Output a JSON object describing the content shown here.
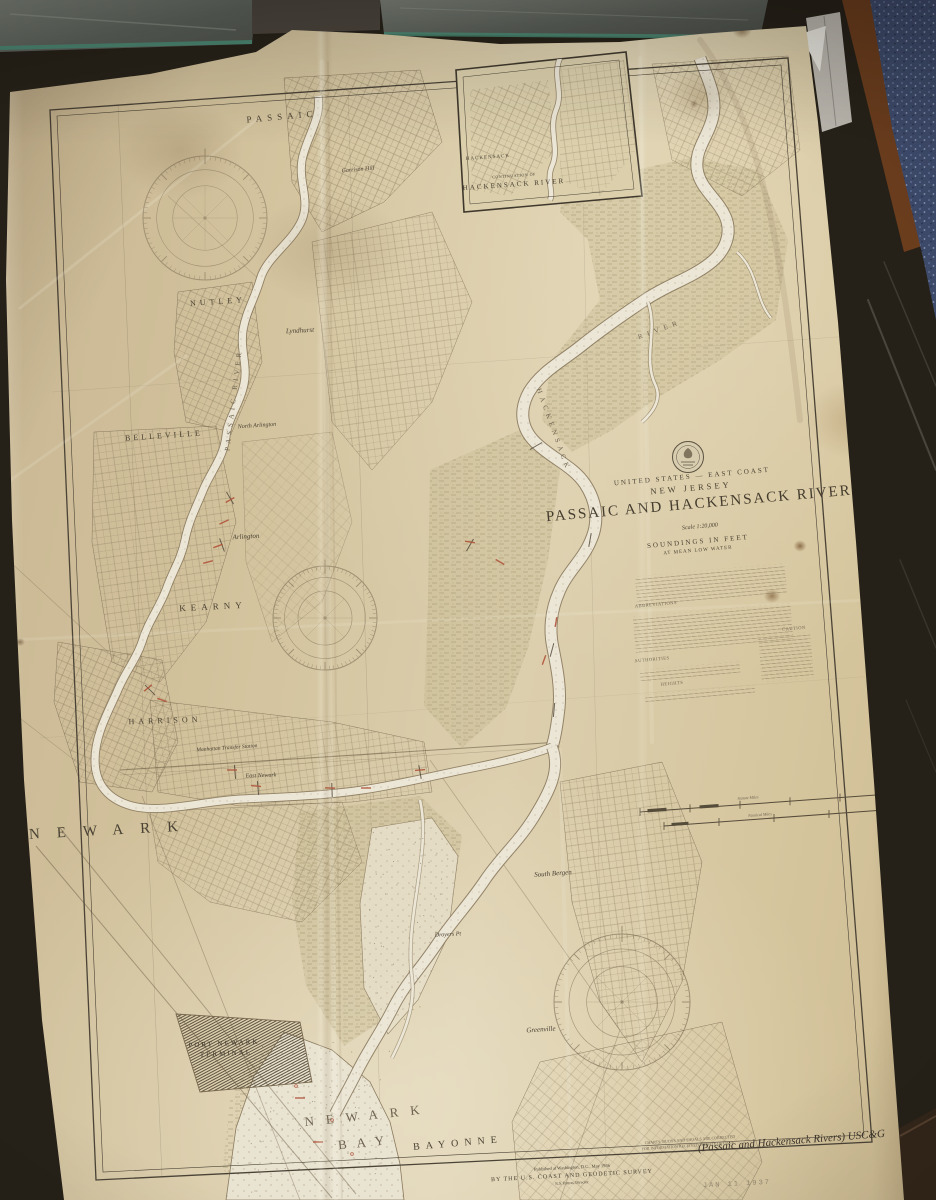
{
  "labels": {
    "passaic_city": "PASSAIC",
    "garrison_hill": "Garrison Hill",
    "nutley": "NUTLEY",
    "lyndhurst": "Lyndhurst",
    "belleville": "BELLEVILLE",
    "north_arlington": "North Arlington",
    "arlington": "Arlington",
    "kearny": "KEARNY",
    "harrison": "HARRISON",
    "manhattan_transfer": "Manhattan Transfer Station",
    "east_newark": "East Newark",
    "newark": "NEWARK",
    "south_bergen": "South Bergen",
    "droyers_pt": "Droyers Pt",
    "greenville": "Greenville",
    "port_newark_1": "PORT NEWARK",
    "port_newark_2": "TERMINAL",
    "newark_bay_1": "NEWARK",
    "newark_bay_2": "BAY",
    "bayonne": "BAYONNE",
    "hackensack_river_a": "HACKENSACK",
    "hackensack_river_b": "RIVER",
    "passaic_river": "PASSAIC RIVER"
  },
  "inset": {
    "town": "HACKENSACK",
    "caption_line1": "CONTINUATION OF",
    "caption_line2": "HACKENSACK RIVER"
  },
  "title": {
    "country": "UNITED STATES — EAST COAST",
    "state": "NEW JERSEY",
    "name": "PASSAIC AND HACKENSACK RIVERS",
    "scale": "Scale 1:20,000",
    "soundings": "SOUNDINGS IN FEET",
    "datum": "AT MEAN LOW WATER"
  },
  "legend": {
    "abbreviations": "ABBREVIATIONS",
    "authorities": "AUTHORITIES",
    "caution": "CAUTION",
    "heights": "HEIGHTS",
    "statute_miles": "Statute Miles",
    "nautical_miles": "Nautical Miles"
  },
  "imprint": {
    "line1": "Published at Washington, D.C., May 1936",
    "line2": "BY THE U.S. COAST AND GEODETIC SURVEY",
    "line3": "R.S. Patton, Director"
  },
  "stamps": {
    "correction_line1": "CHARTS, BUOYS AND SHOALS ARE CORRECTED",
    "correction_line2": "FOR INFORMATION RECEIVED TO DATE OF ISSUE",
    "catalog": "(Passaic and Hackensack Rivers) USC&G",
    "date": "JAN 11 1937"
  },
  "colors": {
    "paper": "#d8c9a6",
    "ink": "#564c3a",
    "river": "#ece6d6",
    "marsh": "#a89a6c",
    "red_note": "#b0543a",
    "counter_blue": "#3d4a6a",
    "wood_trim": "#6e3f1f",
    "glass_edge": "#44836f"
  }
}
